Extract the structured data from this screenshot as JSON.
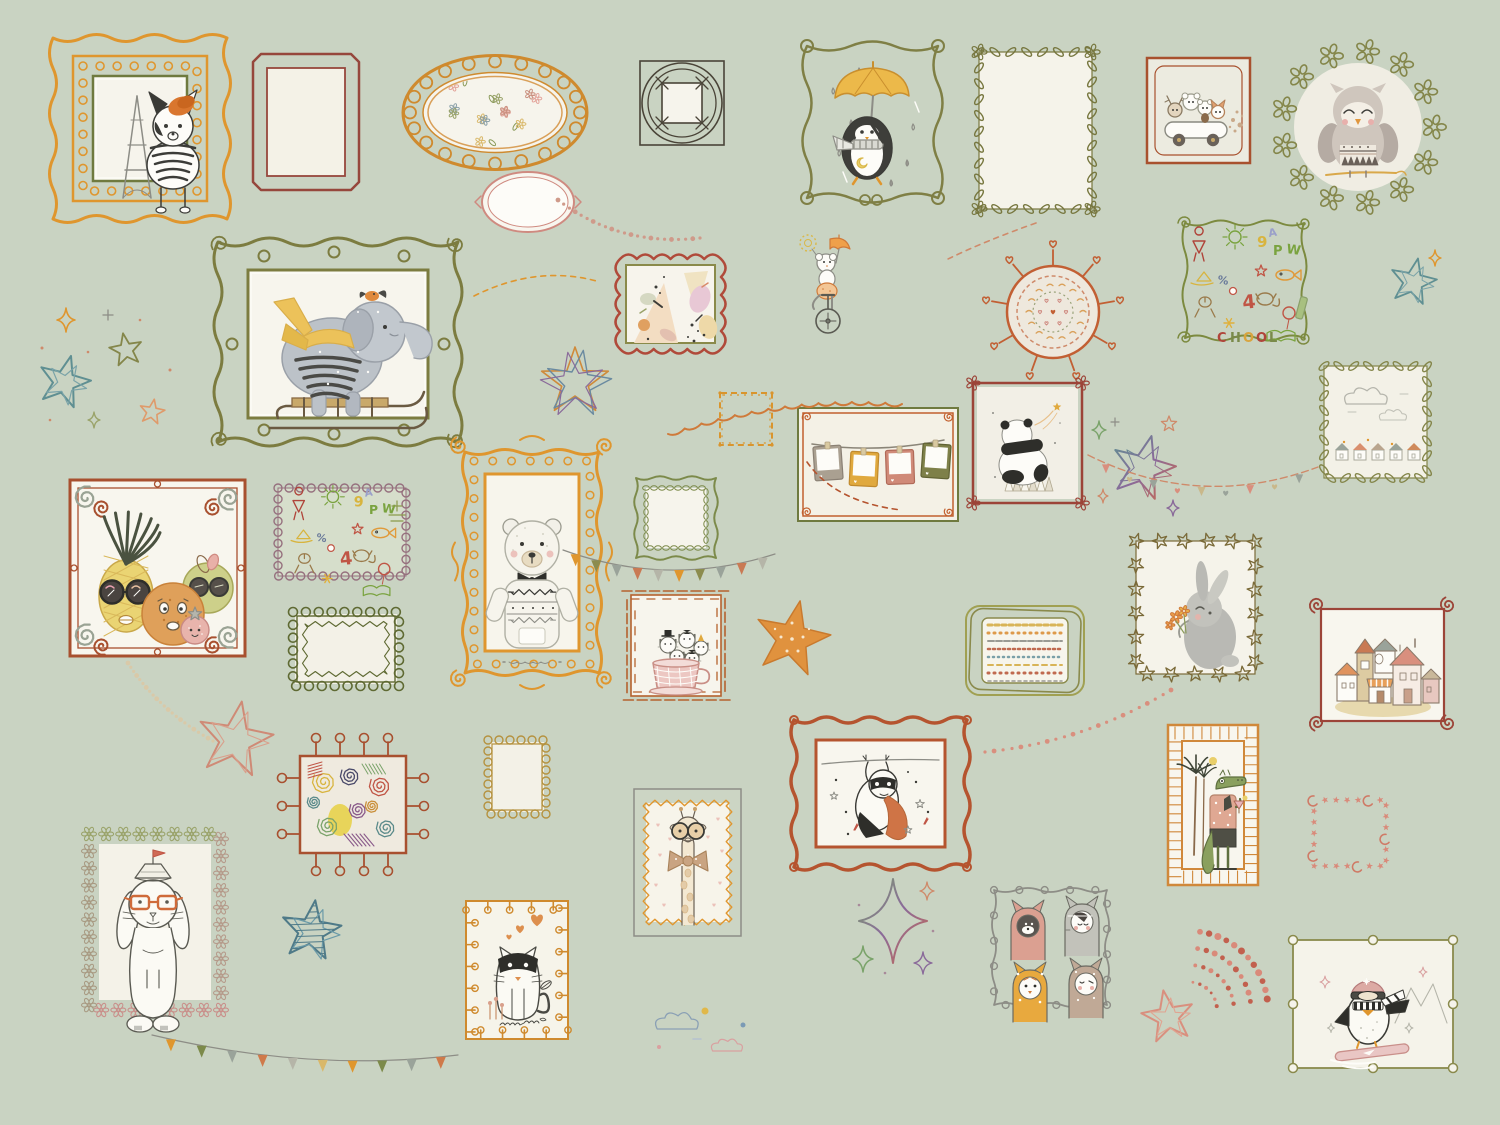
{
  "scene": {
    "title": "Children's gallery wall mural: doodle picture frames with animals, stars and garlands on sage green",
    "background": "#c9d3c2",
    "width": 1500,
    "height": 1125
  },
  "palette": {
    "orange": "#df962e",
    "rust": "#b5542f",
    "maroon": "#9c4a3c",
    "olive": "#84864a",
    "olive_dark": "#6f703c",
    "cream": "#f4f2e7",
    "white": "#fbfaf4",
    "gray": "#8d8d86",
    "ink": "#3c3c38",
    "pink": "#d9998a",
    "yellow": "#e9b83f",
    "brown": "#7a6a42",
    "teal": "#5f8f92",
    "mauve": "#9c8090",
    "sage": "#c9d3c2",
    "salmon": "#d98f7e"
  },
  "items": [
    {
      "id": "dog-paris-frame",
      "motif": "dog-paris",
      "x": 45,
      "y": 30,
      "w": 190,
      "h": 197,
      "desc": "french bulldog with orange beret and striped shirt before Eiffel Tower, ornate orange dotted frame with green trim"
    },
    {
      "id": "empty-red-frame",
      "motif": "empty-double",
      "x": 247,
      "y": 48,
      "w": 118,
      "h": 148,
      "desc": "empty maroon double-line frame"
    },
    {
      "id": "oval-floral-frame",
      "motif": "oval-floral",
      "x": 395,
      "y": 50,
      "w": 200,
      "h": 125,
      "desc": "orange rope oval frame filled with tiny pastel flowers"
    },
    {
      "id": "small-pink-oval-frame",
      "motif": "oval-pink",
      "x": 473,
      "y": 163,
      "w": 110,
      "h": 78,
      "desc": "small empty pink oval frame"
    },
    {
      "id": "woven-square-frame",
      "motif": "woven-square",
      "x": 632,
      "y": 55,
      "w": 100,
      "h": 98,
      "desc": "dark woven square doodle frame, empty"
    },
    {
      "id": "penguin-umbrella",
      "motif": "penguin-umbrella",
      "x": 795,
      "y": 32,
      "w": 155,
      "h": 180,
      "desc": "penguin with yellow umbrella and striped scarf in rain, curly olive frame"
    },
    {
      "id": "leafy-empty-frame",
      "motif": "leafy-empty",
      "x": 963,
      "y": 38,
      "w": 145,
      "h": 185,
      "desc": "empty cream frame bordered with olive leaves"
    },
    {
      "id": "animals-car-frame",
      "motif": "animal-car",
      "x": 1141,
      "y": 52,
      "w": 115,
      "h": 117,
      "desc": "deer, bears and fox riding a little white car, rust frame"
    },
    {
      "id": "owl-wreath",
      "motif": "owl-wreath",
      "x": 1268,
      "y": 35,
      "w": 180,
      "h": 180,
      "desc": "sleepy owl in patterned sweater inside olive flower wreath"
    },
    {
      "id": "elephant-sled-frame",
      "motif": "elephant-sled",
      "x": 208,
      "y": 232,
      "w": 260,
      "h": 220,
      "desc": "elephant with yellow scarf riding wooden sled, tiny bird on head, ornate olive frame"
    },
    {
      "id": "abstract-art-frame",
      "motif": "abstract-art",
      "x": 604,
      "y": 243,
      "w": 133,
      "h": 122,
      "desc": "red scalloped frame with pastel abstract painting"
    },
    {
      "id": "mouse-unicycle",
      "motif": "mouse-unicycle",
      "x": 780,
      "y": 233,
      "w": 85,
      "h": 105,
      "desc": "circus mouse on unicycle holding tiny umbrella and dotted ball"
    },
    {
      "id": "heart-mandala",
      "motif": "mandala",
      "x": 973,
      "y": 232,
      "w": 160,
      "h": 160,
      "desc": "round orange medallion with radiating hearts and pastel mandala rings"
    },
    {
      "id": "school-doodle-frame",
      "motif": "school-doodles",
      "x": 1177,
      "y": 213,
      "w": 135,
      "h": 137,
      "letters": "CHOOL",
      "glyphs": [
        "girl",
        "sun",
        "9",
        "A",
        "P",
        "W",
        "fish",
        "star",
        "4",
        "cat",
        "balloon",
        "book",
        "boat",
        "%",
        "ball",
        "flower",
        "pencil"
      ],
      "desc": "olive scroll frame full of colorful school chalk doodles and letters CHOOL"
    },
    {
      "id": "clouds-houses-frame",
      "motif": "clouds-houses",
      "x": 1308,
      "y": 352,
      "w": 135,
      "h": 140,
      "desc": "leafy olive frame with faint clouds and tiny houses"
    },
    {
      "id": "left-star-cluster",
      "motif": "stars-cluster-left",
      "x": 30,
      "y": 300,
      "w": 150,
      "h": 140,
      "desc": "teal, olive and peach doodle stars with sparkles"
    },
    {
      "id": "multicolor-star",
      "motif": "multicolor-star",
      "x": 535,
      "y": 330,
      "w": 80,
      "h": 100,
      "desc": "overlapping orange, blue and purple sketched star"
    },
    {
      "id": "stitched-square-frame",
      "motif": "stitched-square",
      "x": 712,
      "y": 385,
      "w": 68,
      "h": 68,
      "desc": "small orange stitched square frame, empty"
    },
    {
      "id": "polaroids-frame",
      "motif": "polaroids",
      "x": 792,
      "y": 402,
      "w": 172,
      "h": 125,
      "desc": "frame with clothesline of four polaroid photos: taupe, yellow, pink, olive"
    },
    {
      "id": "panda-frame",
      "motif": "panda",
      "x": 965,
      "y": 373,
      "w": 125,
      "h": 140,
      "desc": "panda sitting on geometric cushion watching shooting star, maroon flower-corner frame"
    },
    {
      "id": "rainbow-stars",
      "motif": "rainbow-stars",
      "x": 1085,
      "y": 410,
      "w": 105,
      "h": 115,
      "desc": "gradient rainbow star outlines and sparkles"
    },
    {
      "id": "right-teal-star",
      "motif": "star-teal-right",
      "x": 1385,
      "y": 248,
      "w": 60,
      "h": 62,
      "desc": "teal star doodle with orange sparkle"
    },
    {
      "id": "fruit-glasses-frame",
      "motif": "fruit-glasses",
      "x": 60,
      "y": 468,
      "w": 195,
      "h": 200,
      "desc": "pineapple, orange, apple and strawberry wearing glasses, rust frame with corner swirls"
    },
    {
      "id": "school-doodle-frame-2",
      "motif": "school-doodles-2",
      "x": 266,
      "y": 476,
      "w": 152,
      "h": 112,
      "glyphs": [
        "dancer",
        "boat",
        "%",
        "figure",
        "star",
        "chick",
        "fish",
        "dog",
        "4",
        "cat",
        "balloon",
        "book",
        "ball",
        "flower",
        "tictactoe"
      ],
      "desc": "mauve loop frame with colorful kid doodles"
    },
    {
      "id": "olive-loop-frame",
      "motif": "olive-loop-frame",
      "x": 281,
      "y": 600,
      "w": 130,
      "h": 98,
      "desc": "dark olive loop frame with zigzag inner edge, empty"
    },
    {
      "id": "polar-bear-frame",
      "motif": "polar-bear",
      "x": 447,
      "y": 430,
      "w": 170,
      "h": 265,
      "desc": "polar bear with bow tie and patterned sweater, ornate golden-orange frame"
    },
    {
      "id": "squiggle-frame",
      "motif": "squiggle-frame",
      "x": 626,
      "y": 468,
      "w": 100,
      "h": 100,
      "desc": "olive wavy frame with beaded inner ring, empty"
    },
    {
      "id": "cats-teacup-frame",
      "motif": "cats-teacup",
      "x": 621,
      "y": 583,
      "w": 110,
      "h": 125,
      "desc": "litter of kittens with tiny hats in a pink teacup, rust bamboo frame"
    },
    {
      "id": "orange-star",
      "motif": "orange-star",
      "x": 745,
      "y": 593,
      "w": 95,
      "h": 95,
      "desc": "solid orange star with white dots"
    },
    {
      "id": "striped-pattern-frame",
      "motif": "striped-frame",
      "x": 960,
      "y": 598,
      "w": 130,
      "h": 105,
      "desc": "olive rounded frame filled with embroidered stripe bands"
    },
    {
      "id": "bunny-flower-frame",
      "motif": "bunny-flowers",
      "x": 1118,
      "y": 525,
      "w": 155,
      "h": 165,
      "desc": "gray bunny holding orange flowers, star-leaf vine frame"
    },
    {
      "id": "houses-frame",
      "motif": "houses",
      "x": 1305,
      "y": 595,
      "w": 155,
      "h": 140,
      "desc": "cluster of pastel cottages, maroon spiral-corner frame"
    },
    {
      "id": "pink-star-outline",
      "motif": "pink-star",
      "x": 190,
      "y": 698,
      "w": 90,
      "h": 85,
      "desc": "salmon sketched star outline"
    },
    {
      "id": "scribble-frame",
      "motif": "scribbles",
      "x": 288,
      "y": 742,
      "w": 130,
      "h": 125,
      "desc": "rust pin frame full of colorful crayon scribble rosettes"
    },
    {
      "id": "small-loop-square-frame",
      "motif": "small-loop-square",
      "x": 478,
      "y": 728,
      "w": 78,
      "h": 98,
      "desc": "small tan loop frame, empty"
    },
    {
      "id": "bunny-boat-frame",
      "motif": "bunny-boat",
      "x": 73,
      "y": 820,
      "w": 165,
      "h": 205,
      "desc": "sketched lop-eared bunny with orange glasses and paper-boat hat, flower border frame"
    },
    {
      "id": "teal-striped-star",
      "motif": "teal-star",
      "x": 278,
      "y": 885,
      "w": 70,
      "h": 95,
      "desc": "teal striped doodle star"
    },
    {
      "id": "masked-cat-frame",
      "motif": "masked-cat",
      "x": 452,
      "y": 885,
      "w": 130,
      "h": 170,
      "desc": "white cat in black superhero mask with orange hearts, stitched orange frame"
    },
    {
      "id": "giraffe-frame",
      "motif": "giraffe",
      "x": 630,
      "y": 785,
      "w": 115,
      "h": 155,
      "desc": "giraffe with round glasses and big polka bow, orange zigzag frame on sage mat"
    },
    {
      "id": "sloth-hero-frame",
      "motif": "sloth-hero",
      "x": 788,
      "y": 712,
      "w": 185,
      "h": 165,
      "desc": "masked sloth hero with orange cape hanging from a line, rust wavy frame"
    },
    {
      "id": "sparkle-diamonds",
      "motif": "sparkles",
      "x": 845,
      "y": 875,
      "w": 95,
      "h": 105,
      "desc": "four-point gradient sparkles"
    },
    {
      "id": "four-cats-frame",
      "motif": "four-cats",
      "x": 988,
      "y": 880,
      "w": 125,
      "h": 135,
      "desc": "four kittens in hoodies: pink, striped gray, orange polka, taupe dotted; gray wavy dot border"
    },
    {
      "id": "pink-star-small",
      "motif": "pink-star-small",
      "x": 1138,
      "y": 975,
      "w": 60,
      "h": 85,
      "desc": "small pink star outline"
    },
    {
      "id": "crocodile-frame",
      "motif": "crocodile",
      "x": 1158,
      "y": 715,
      "w": 110,
      "h": 180,
      "desc": "crocodile in tropical shirt with cocktail beside palm trees, orange sunburst frame"
    },
    {
      "id": "stars-moons-frame",
      "motif": "stars-moons-frame",
      "x": 1300,
      "y": 788,
      "w": 100,
      "h": 90,
      "desc": "empty frame drawn from tiny pink stars and crescent moons"
    },
    {
      "id": "penguin-surf-frame",
      "motif": "penguin-surf",
      "x": 1283,
      "y": 928,
      "w": 180,
      "h": 152,
      "desc": "penguin in pink helmet and striped scarf riding pink snowboard, olive loop frame"
    },
    {
      "id": "dot-spray",
      "motif": "dot-spray",
      "x": 1175,
      "y": 918,
      "w": 125,
      "h": 100,
      "desc": "fan of red confetti dots"
    },
    {
      "id": "small-clouds",
      "motif": "clouds-small",
      "x": 645,
      "y": 995,
      "w": 120,
      "h": 70,
      "desc": "tiny pastel clouds and dots"
    },
    {
      "id": "garland-dots-top",
      "motif": "garland",
      "kind": "dots",
      "x": 540,
      "y": 185,
      "w": 170,
      "h": 70,
      "p": [
        [
          18,
          15
        ],
        [
          80,
          62
        ],
        [
          160,
          53
        ]
      ],
      "colors": [
        "#cf9a8a"
      ],
      "desc": "dotted garland"
    },
    {
      "id": "garland-scallop",
      "motif": "garland",
      "kind": "scallop",
      "x": 660,
      "y": 392,
      "w": 250,
      "h": 55,
      "p": [
        [
          8,
          42
        ],
        [
          125,
          2
        ],
        [
          242,
          12
        ]
      ],
      "colors": [
        "#cf7a3a"
      ],
      "desc": "orange scallop garland"
    },
    {
      "id": "garland-hearts",
      "motif": "garland",
      "kind": "hearts",
      "x": 1080,
      "y": 445,
      "w": 245,
      "h": 80,
      "p": [
        [
          8,
          10
        ],
        [
          120,
          66
        ],
        [
          238,
          22
        ]
      ],
      "colors": [
        "#d98f7e",
        "#c9b88a",
        "#9aa39a"
      ],
      "desc": "heart bunting"
    },
    {
      "id": "garland-flags-mid",
      "motif": "garland",
      "kind": "flags",
      "x": 553,
      "y": 542,
      "w": 230,
      "h": 55,
      "p": [
        [
          10,
          8
        ],
        [
          115,
          46
        ],
        [
          222,
          12
        ]
      ],
      "colors": [
        "#df962e",
        "#8c8c4e",
        "#9aa39a",
        "#c97a54",
        "#b5b5a8"
      ],
      "desc": "triangle flag banner"
    },
    {
      "id": "garland-flags-bottom",
      "motif": "garland",
      "kind": "flags",
      "x": 140,
      "y": 1025,
      "w": 325,
      "h": 55,
      "p": [
        [
          12,
          10
        ],
        [
          170,
          48
        ],
        [
          318,
          30
        ]
      ],
      "colors": [
        "#df962e",
        "#7c8a4a",
        "#9aa39a",
        "#cf7a4a",
        "#b5b5a8",
        "#d9b86a"
      ],
      "desc": "bottom flag banner"
    },
    {
      "id": "garland-dots-right",
      "motif": "garland",
      "kind": "dots",
      "x": 975,
      "y": 680,
      "w": 205,
      "h": 85,
      "p": [
        [
          196,
          10
        ],
        [
          110,
          62
        ],
        [
          10,
          72
        ]
      ],
      "colors": [
        "#d98f7e"
      ],
      "desc": "dotted trail"
    },
    {
      "id": "garland-dots-left",
      "motif": "garland",
      "kind": "dots",
      "x": 118,
      "y": 655,
      "w": 105,
      "h": 95,
      "p": [
        [
          10,
          8
        ],
        [
          40,
          55
        ],
        [
          95,
          86
        ]
      ],
      "colors": [
        "#d9c9a8"
      ],
      "desc": "pale dotted trail"
    },
    {
      "id": "garland-dash-rust",
      "motif": "garland",
      "kind": "dash",
      "x": 795,
      "y": 450,
      "w": 115,
      "h": 70,
      "p": [
        [
          12,
          12
        ],
        [
          40,
          52
        ],
        [
          106,
          60
        ]
      ],
      "colors": [
        "#b5542f"
      ],
      "desc": "rust dashed line"
    },
    {
      "id": "garland-dash-tr",
      "motif": "garland",
      "kind": "dash",
      "x": 940,
      "y": 215,
      "w": 105,
      "h": 50,
      "p": [
        [
          96,
          8
        ],
        [
          45,
          26
        ],
        [
          8,
          44
        ]
      ],
      "colors": [
        "#cf8a6a"
      ],
      "desc": "dashed line"
    },
    {
      "id": "garland-dash-elephant",
      "motif": "garland",
      "kind": "dash",
      "x": 468,
      "y": 258,
      "w": 140,
      "h": 50,
      "p": [
        [
          6,
          38
        ],
        [
          70,
          6
        ],
        [
          132,
          24
        ]
      ],
      "colors": [
        "#df962e"
      ],
      "desc": "orange dashed curve"
    }
  ]
}
